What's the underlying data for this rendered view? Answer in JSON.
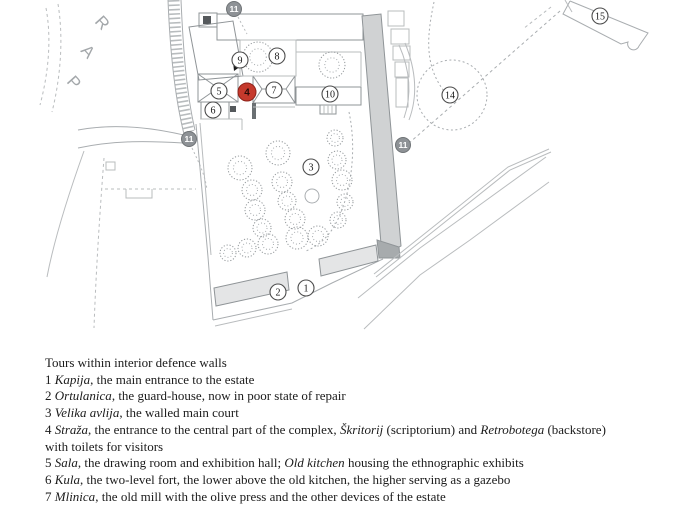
{
  "map": {
    "park_letters": [
      {
        "ch": "P",
        "x": 66,
        "y": 82
      },
      {
        "ch": "A",
        "x": 80,
        "y": 51
      },
      {
        "ch": "R",
        "x": 94,
        "y": 22
      }
    ],
    "markers": [
      {
        "label": "1",
        "x": 306,
        "y": 288,
        "type": "plain"
      },
      {
        "label": "2",
        "x": 278,
        "y": 292,
        "type": "plain"
      },
      {
        "label": "3",
        "x": 311,
        "y": 167,
        "type": "plain"
      },
      {
        "label": "4",
        "x": 247,
        "y": 92,
        "type": "red"
      },
      {
        "label": "5",
        "x": 219,
        "y": 91,
        "type": "plain"
      },
      {
        "label": "6",
        "x": 213,
        "y": 110,
        "type": "plain"
      },
      {
        "label": "7",
        "x": 274,
        "y": 90,
        "type": "plain"
      },
      {
        "label": "8",
        "x": 277,
        "y": 56,
        "type": "plain"
      },
      {
        "label": "9",
        "x": 240,
        "y": 60,
        "type": "plain"
      },
      {
        "label": "10",
        "x": 330,
        "y": 94,
        "type": "plain"
      },
      {
        "label": "11",
        "x": 234,
        "y": 9,
        "type": "gray"
      },
      {
        "label": "11",
        "x": 189,
        "y": 139,
        "type": "gray"
      },
      {
        "label": "11",
        "x": 403,
        "y": 145,
        "type": "gray"
      },
      {
        "label": "14",
        "x": 450,
        "y": 95,
        "type": "plain"
      },
      {
        "label": "15",
        "x": 600,
        "y": 16,
        "type": "plain"
      }
    ],
    "trees": [
      {
        "x": 258,
        "y": 57,
        "r": 15
      },
      {
        "x": 332,
        "y": 65,
        "r": 13
      },
      {
        "x": 240,
        "y": 168,
        "r": 12
      },
      {
        "x": 252,
        "y": 190,
        "r": 10
      },
      {
        "x": 255,
        "y": 210,
        "r": 10
      },
      {
        "x": 262,
        "y": 228,
        "r": 9
      },
      {
        "x": 268,
        "y": 244,
        "r": 10
      },
      {
        "x": 247,
        "y": 248,
        "r": 9
      },
      {
        "x": 228,
        "y": 253,
        "r": 8
      },
      {
        "x": 278,
        "y": 153,
        "r": 12
      },
      {
        "x": 282,
        "y": 182,
        "r": 10
      },
      {
        "x": 287,
        "y": 201,
        "r": 9
      },
      {
        "x": 295,
        "y": 219,
        "r": 10
      },
      {
        "x": 297,
        "y": 238,
        "r": 11
      },
      {
        "x": 318,
        "y": 236,
        "r": 10
      },
      {
        "x": 335,
        "y": 138,
        "r": 8
      },
      {
        "x": 337,
        "y": 160,
        "r": 9
      },
      {
        "x": 342,
        "y": 180,
        "r": 10
      },
      {
        "x": 345,
        "y": 202,
        "r": 8
      },
      {
        "x": 338,
        "y": 220,
        "r": 8
      }
    ],
    "well": {
      "x": 312,
      "y": 196,
      "r": 7
    },
    "colors": {
      "marker_red": "#c5392c",
      "marker_gray": "#8e9296",
      "drawing_line": "#9aa0a3"
    }
  },
  "legend": {
    "title": "Tours within interior defence walls",
    "lines": [
      [
        {
          "t": "1 "
        },
        {
          "t": "Kapija",
          "i": true
        },
        {
          "t": ", the main entrance to the estate"
        }
      ],
      [
        {
          "t": "2 "
        },
        {
          "t": "Ortulanica",
          "i": true
        },
        {
          "t": ", the guard-house, now in poor state of repair"
        }
      ],
      [
        {
          "t": "3 "
        },
        {
          "t": "Velika avlija",
          "i": true
        },
        {
          "t": ", the walled main court"
        }
      ],
      [
        {
          "t": "4 "
        },
        {
          "t": "Straža",
          "i": true
        },
        {
          "t": ", the entrance to the central part of the complex, "
        },
        {
          "t": "Škritorij",
          "i": true
        },
        {
          "t": " (scriptorium) and "
        },
        {
          "t": "Retrobotega",
          "i": true
        },
        {
          "t": " (backstore)"
        }
      ],
      [
        {
          "t": "with toilets for visitors"
        }
      ],
      [
        {
          "t": "5 "
        },
        {
          "t": "Sala",
          "i": true
        },
        {
          "t": ", the drawing room and exhibition hall; "
        },
        {
          "t": "Old kitchen",
          "i": true
        },
        {
          "t": " housing the ethnographic exhibits"
        }
      ],
      [
        {
          "t": "6 "
        },
        {
          "t": "Kula",
          "i": true
        },
        {
          "t": ", the two-level fort, the lower above the old kitchen, the higher serving as a gazebo"
        }
      ],
      [
        {
          "t": "7 "
        },
        {
          "t": "Mlinica",
          "i": true
        },
        {
          "t": ", the old mill with the olive press and the other devices of the estate"
        }
      ]
    ]
  }
}
